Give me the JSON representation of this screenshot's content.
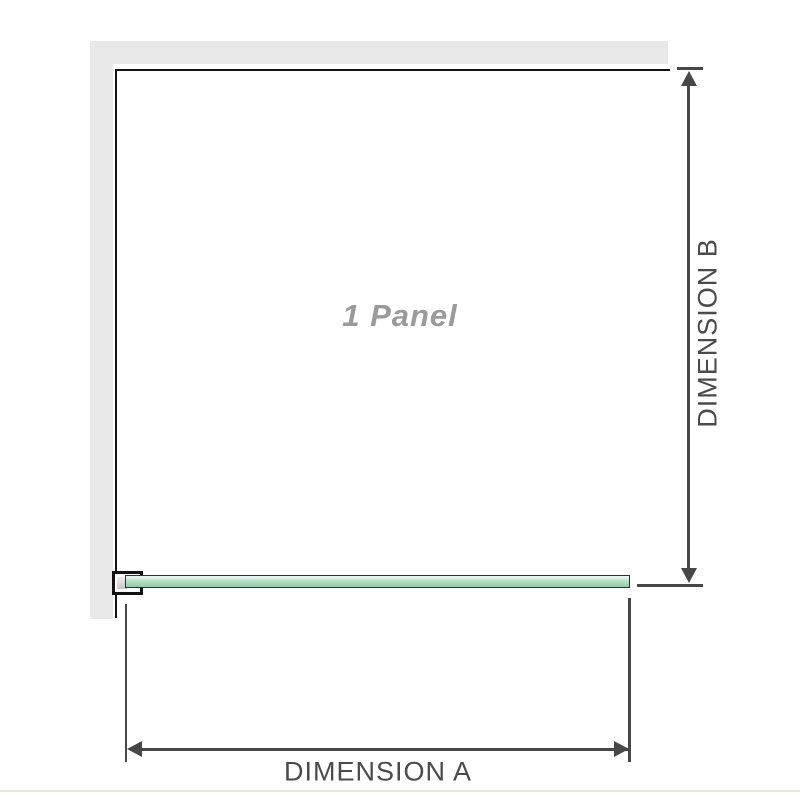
{
  "diagram": {
    "title": "1 Panel",
    "dimension_a": {
      "label": "DIMENSION A"
    },
    "dimension_b": {
      "label": "DIMENSION B"
    },
    "panel_count": 1
  },
  "colors": {
    "background": "#ffffff",
    "wall": "#e8e8e8",
    "outline": "#121212",
    "dimension_line": "#474747",
    "label_text": "#4a4a4a",
    "panel_text": "#9a9a9a",
    "glass_border": "#2b332d",
    "glass_light": "#e9f6ee",
    "glass_mid": "#b5dfc7",
    "glass_deep": "#90cdaa",
    "glass_end_gray": "#c6c6c6",
    "baseline": "#eae6dd"
  }
}
